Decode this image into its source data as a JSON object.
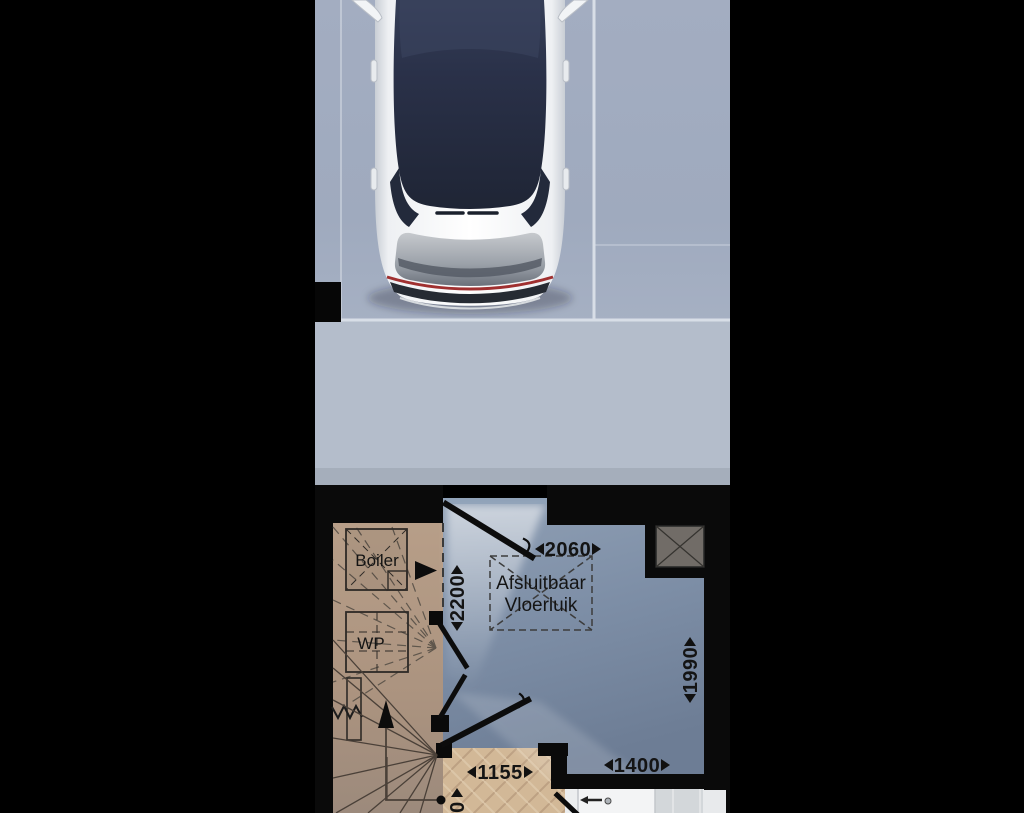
{
  "plan": {
    "labels": {
      "boiler": "Boiler",
      "wp": "WP",
      "vloerluik_line1": "Afsluitbaar",
      "vloerluik_line2": "Vloerluik"
    },
    "dimensions": {
      "garage_top": "2060",
      "garage_left": "2200",
      "garage_right": "1990",
      "bottom_right": "1400",
      "hall": "1155",
      "bottom_partial": "0"
    },
    "icons": {
      "dimension_arrow_left": "left solid triangle",
      "dimension_arrow_right": "right solid triangle",
      "stairs_direction": "up solid triangle",
      "technical_room_arrow": "right solid triangle",
      "shaft": "crossed gray box",
      "floor_hatch": "dashed crossed rectangle"
    },
    "colors": {
      "background": "#000000",
      "driveway_concrete": "#a7b1c4",
      "driveway_lower_slab": "#b4bdcb",
      "garage_floor": "#8093ab",
      "technical_room_floor": "#b59c86",
      "parquet_floor": "#d2b897",
      "bathroom_tile": "#d3d7da",
      "wall": "#0a0a0a",
      "shaft_fill": "#716c67",
      "car_body": "#f4f6f8",
      "car_glass": "#262e44",
      "car_taillight": "#a03030"
    }
  }
}
